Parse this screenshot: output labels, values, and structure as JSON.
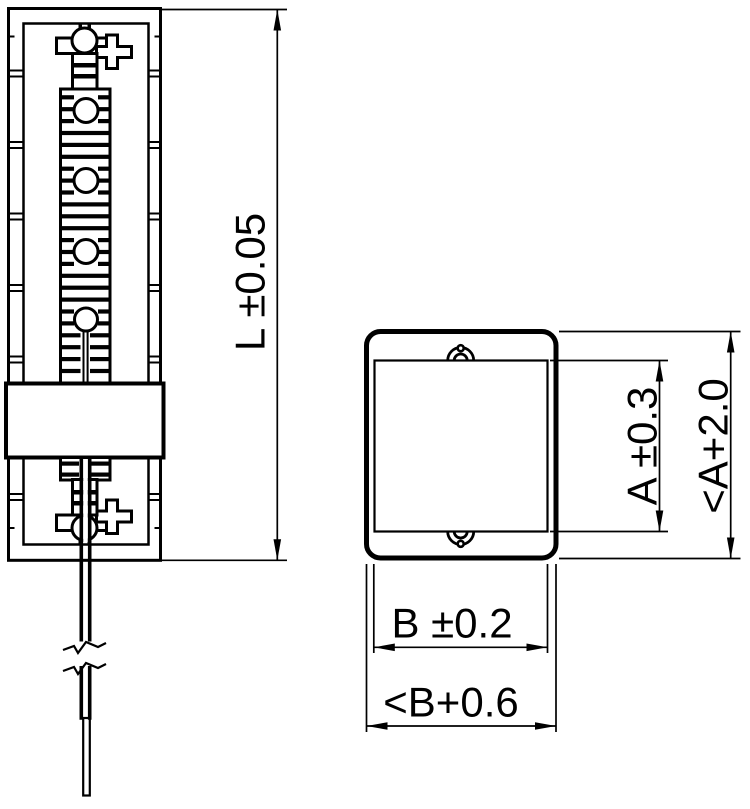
{
  "drawing": {
    "colors": {
      "ink": "#000000",
      "background": "#ffffff"
    },
    "dimensions": {
      "length": "L ±0.05",
      "height_inner": "A ±0.3",
      "height_outer": "<A+2.0",
      "width_inner": "B ±0.2",
      "width_outer": "<B+0.6"
    }
  }
}
